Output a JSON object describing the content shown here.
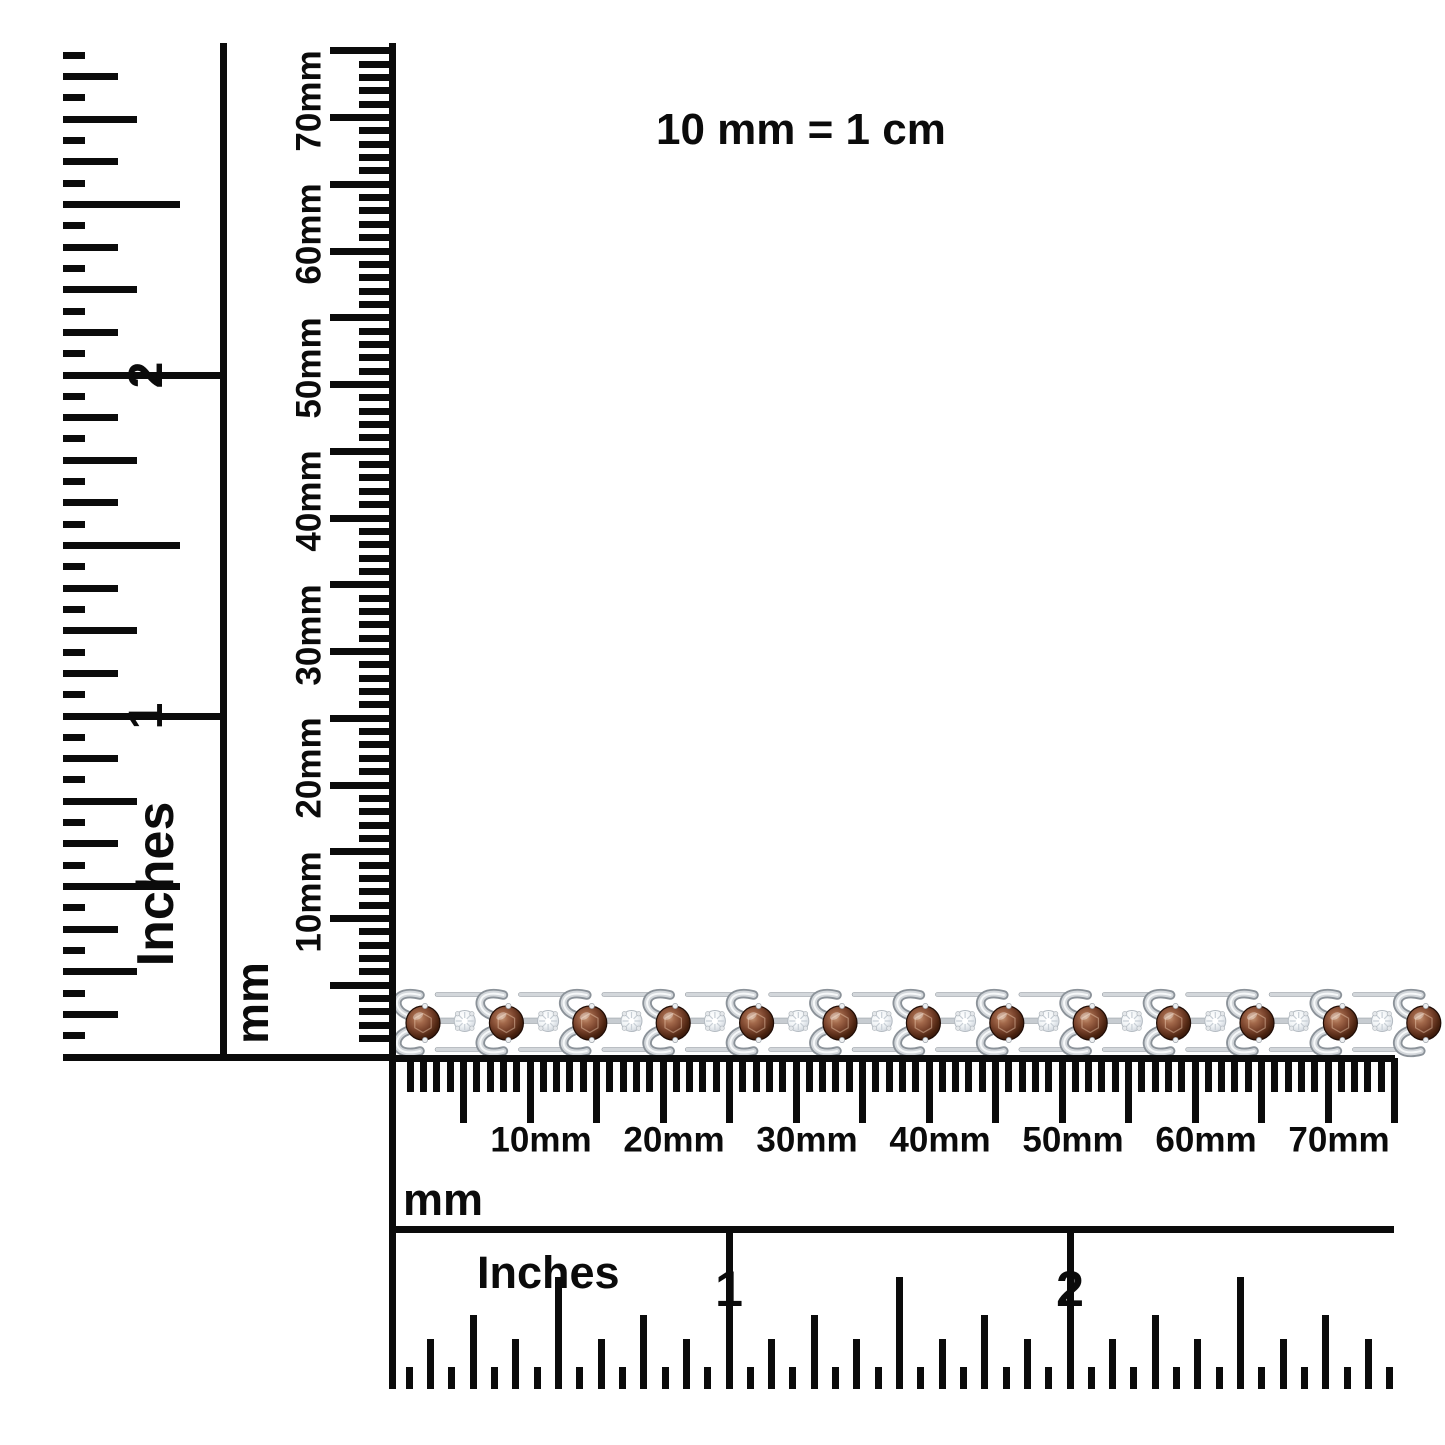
{
  "scale_note": {
    "text": "10 mm = 1 cm"
  },
  "colors": {
    "ink": "#0b0b0b",
    "background": "#ffffff",
    "metal_light": "#d3d7db",
    "metal_mid": "#c7ccd1",
    "metal_dark": "#8b9299",
    "stone_brown": "#79432c",
    "stone_brown_deep": "#2b1008",
    "diamond_white": "#f2f5f7"
  },
  "bracelet": {
    "description": "Silver S-link tennis bracelet with round chocolate-brown gemstones alternating with small round white diamonds",
    "stone_count": 13,
    "diamond_count": 12
  },
  "rulers": {
    "left_inches": {
      "unit_label": "Inches",
      "numbers": [
        "1",
        "2"
      ],
      "ticks_per_inch": 16,
      "length_inches": 3
    },
    "left_mm": {
      "unit_label": "mm",
      "labels": [
        "10mm",
        "20mm",
        "30mm",
        "40mm",
        "50mm",
        "60mm",
        "70mm"
      ],
      "length_mm": 75
    },
    "bottom_mm": {
      "unit_label": "mm",
      "labels": [
        "10mm",
        "20mm",
        "30mm",
        "40mm",
        "50mm",
        "60mm",
        "70mm"
      ],
      "length_mm": 75
    },
    "bottom_inches": {
      "unit_label": "Inches",
      "numbers": [
        "1",
        "2"
      ],
      "ticks_per_inch": 16,
      "length_inches": 3
    }
  }
}
